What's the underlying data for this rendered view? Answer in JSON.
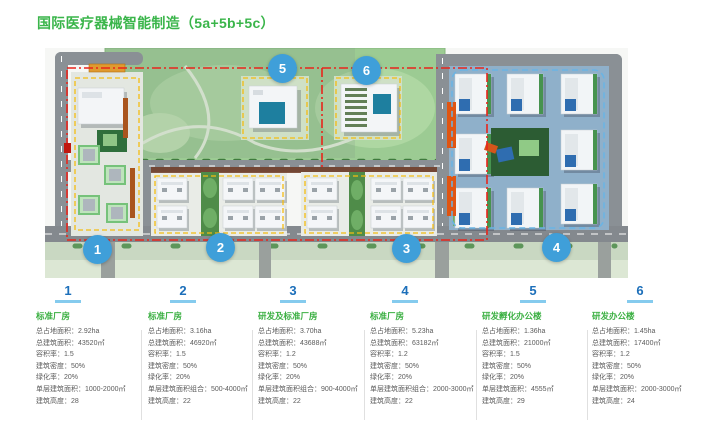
{
  "title": "国际医疗器械智能制造（5a+5b+5c）",
  "colors": {
    "title_green": "#3ab54a",
    "block_title_green": "#3cb043",
    "number_blue": "#1c6fba",
    "underline_blue": "#85cbee",
    "marker_blue": "#3f9fd9",
    "boundary_red": "#e8251c",
    "plot_outline_yellow": "#f3bc12",
    "plot_outline_blue": "#6ab4e4"
  },
  "map": {
    "markers": [
      {
        "label": "1"
      },
      {
        "label": "2"
      },
      {
        "label": "3"
      },
      {
        "label": "4"
      },
      {
        "label": "5"
      },
      {
        "label": "6"
      }
    ]
  },
  "blocks": [
    {
      "no": "1",
      "name": "标准厂房",
      "items": [
        {
          "label": "总占地面积",
          "value": "2.92ha"
        },
        {
          "label": "总建筑面积",
          "value": "43520㎡"
        },
        {
          "label": "容积率",
          "value": "1.5"
        },
        {
          "label": "建筑密度",
          "value": "50%"
        },
        {
          "label": "绿化率",
          "value": "20%"
        },
        {
          "label": "单层建筑面积",
          "value": "1000-2000㎡"
        },
        {
          "label": "建筑高度",
          "value": "28"
        }
      ]
    },
    {
      "no": "2",
      "name": "标准厂房",
      "items": [
        {
          "label": "总占地面积",
          "value": "3.16ha"
        },
        {
          "label": "总建筑面积",
          "value": "46920㎡"
        },
        {
          "label": "容积率",
          "value": "1.5"
        },
        {
          "label": "建筑密度",
          "value": "50%"
        },
        {
          "label": "绿化率",
          "value": "20%"
        },
        {
          "label": "单层建筑面积组合",
          "value": "500-4000㎡"
        },
        {
          "label": "建筑高度",
          "value": "22"
        }
      ]
    },
    {
      "no": "3",
      "name": "研发及标准厂房",
      "items": [
        {
          "label": "总占地面积",
          "value": "3.70ha"
        },
        {
          "label": "总建筑面积",
          "value": "43688㎡"
        },
        {
          "label": "容积率",
          "value": "1.2"
        },
        {
          "label": "建筑密度",
          "value": "50%"
        },
        {
          "label": "绿化率",
          "value": "20%"
        },
        {
          "label": "单层建筑面积组合",
          "value": "900-4000㎡"
        },
        {
          "label": "建筑高度",
          "value": "22"
        }
      ]
    },
    {
      "no": "4",
      "name": "标准厂房",
      "items": [
        {
          "label": "总占地面积",
          "value": "5.23ha"
        },
        {
          "label": "总建筑面积",
          "value": "63182㎡"
        },
        {
          "label": "容积率",
          "value": "1.2"
        },
        {
          "label": "建筑密度",
          "value": "50%"
        },
        {
          "label": "绿化率",
          "value": "20%"
        },
        {
          "label": "单层建筑面积组合",
          "value": "2000-3000㎡"
        },
        {
          "label": "建筑高度",
          "value": "22"
        }
      ]
    },
    {
      "no": "5",
      "name": "研发孵化办公楼",
      "items": [
        {
          "label": "总占地面积",
          "value": "1.36ha"
        },
        {
          "label": "总建筑面积",
          "value": "21000㎡"
        },
        {
          "label": "容积率",
          "value": "1.5"
        },
        {
          "label": "建筑密度",
          "value": "50%"
        },
        {
          "label": "绿化率",
          "value": "20%"
        },
        {
          "label": "单层建筑面积",
          "value": "4555㎡"
        },
        {
          "label": "建筑高度",
          "value": "29"
        }
      ]
    },
    {
      "no": "6",
      "name": "研发办公楼",
      "items": [
        {
          "label": "总占地面积",
          "value": "1.45ha"
        },
        {
          "label": "总建筑面积",
          "value": "17400㎡"
        },
        {
          "label": "容积率",
          "value": "1.2"
        },
        {
          "label": "建筑密度",
          "value": "50%"
        },
        {
          "label": "绿化率",
          "value": "20%"
        },
        {
          "label": "单层建筑面积",
          "value": "2000-3000㎡"
        },
        {
          "label": "建筑高度",
          "value": "24"
        }
      ]
    }
  ]
}
